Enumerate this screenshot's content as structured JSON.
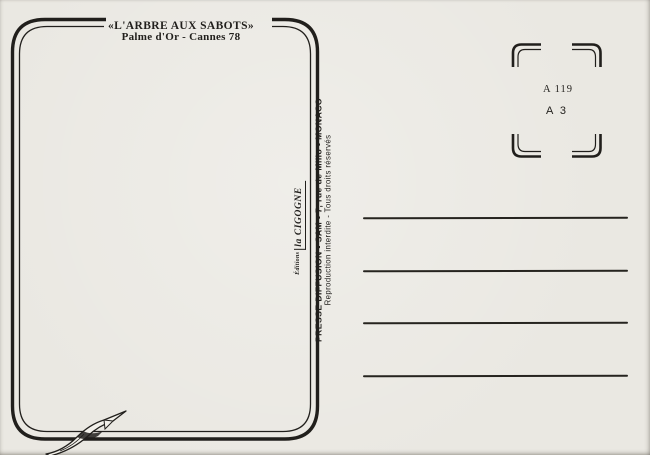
{
  "card": {
    "title": {
      "line1": "«L'ARBRE AUX SABOTS»",
      "line2": "Palme d'Or - Cannes 78"
    },
    "publisher": {
      "line1": "PRESSE DIFFUSION - SAM - 7, rue de Millo - MONACO",
      "line2": "Reproduction interdite - Tous droits réservés"
    },
    "logo": {
      "prefix": "Éditions",
      "name": "la CIGOGNE"
    },
    "stamp": {
      "code1": "A 119",
      "code2": "A 3"
    },
    "address": {
      "count": 4
    },
    "colors": {
      "paper": "#eae8e2",
      "ink": "#211f1c",
      "ribbon": "#f2f0ea"
    }
  }
}
